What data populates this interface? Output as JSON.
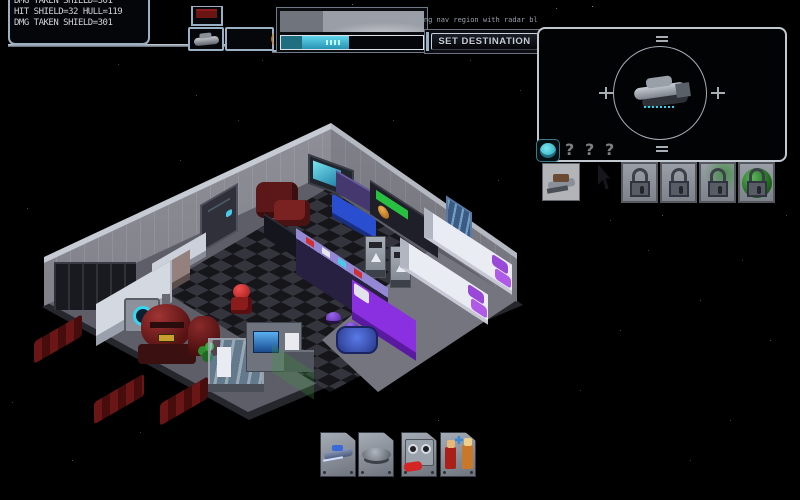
{
  "window": {
    "width": 800,
    "height": 500
  },
  "colors": {
    "accent_cyan": "#41c4e4",
    "hud_silver": "#9cb0c4",
    "ammo_orange": "#c8882e",
    "lock_green": "#2f8f2f",
    "hull_red": "#6a1616"
  },
  "hud": {
    "combat_log": [
      "DMG TAKEN SHIELD=301",
      "HIT SHIELD=32 HULL=119",
      "DMG TAKEN SHIELD=301"
    ],
    "ammo_count": "(1)8",
    "status_note": "Adding nav region with radar bldg",
    "destination_button": "SET DESTINATION",
    "progress_pct": 48
  },
  "radar": {
    "unknown_slots": [
      "?",
      "?",
      "?"
    ],
    "locked_slot_count": 4,
    "icons": {
      "badge": "brain-icon",
      "contact": "ship-sprite",
      "thumbnail": "away-ship-thumbnail",
      "lock": "padlock-icon",
      "planet": "green-planet-icon"
    }
  },
  "inventory": {
    "items": [
      "scout-ship",
      "hover-platform",
      "gauge-machine",
      "crew-figures"
    ]
  }
}
